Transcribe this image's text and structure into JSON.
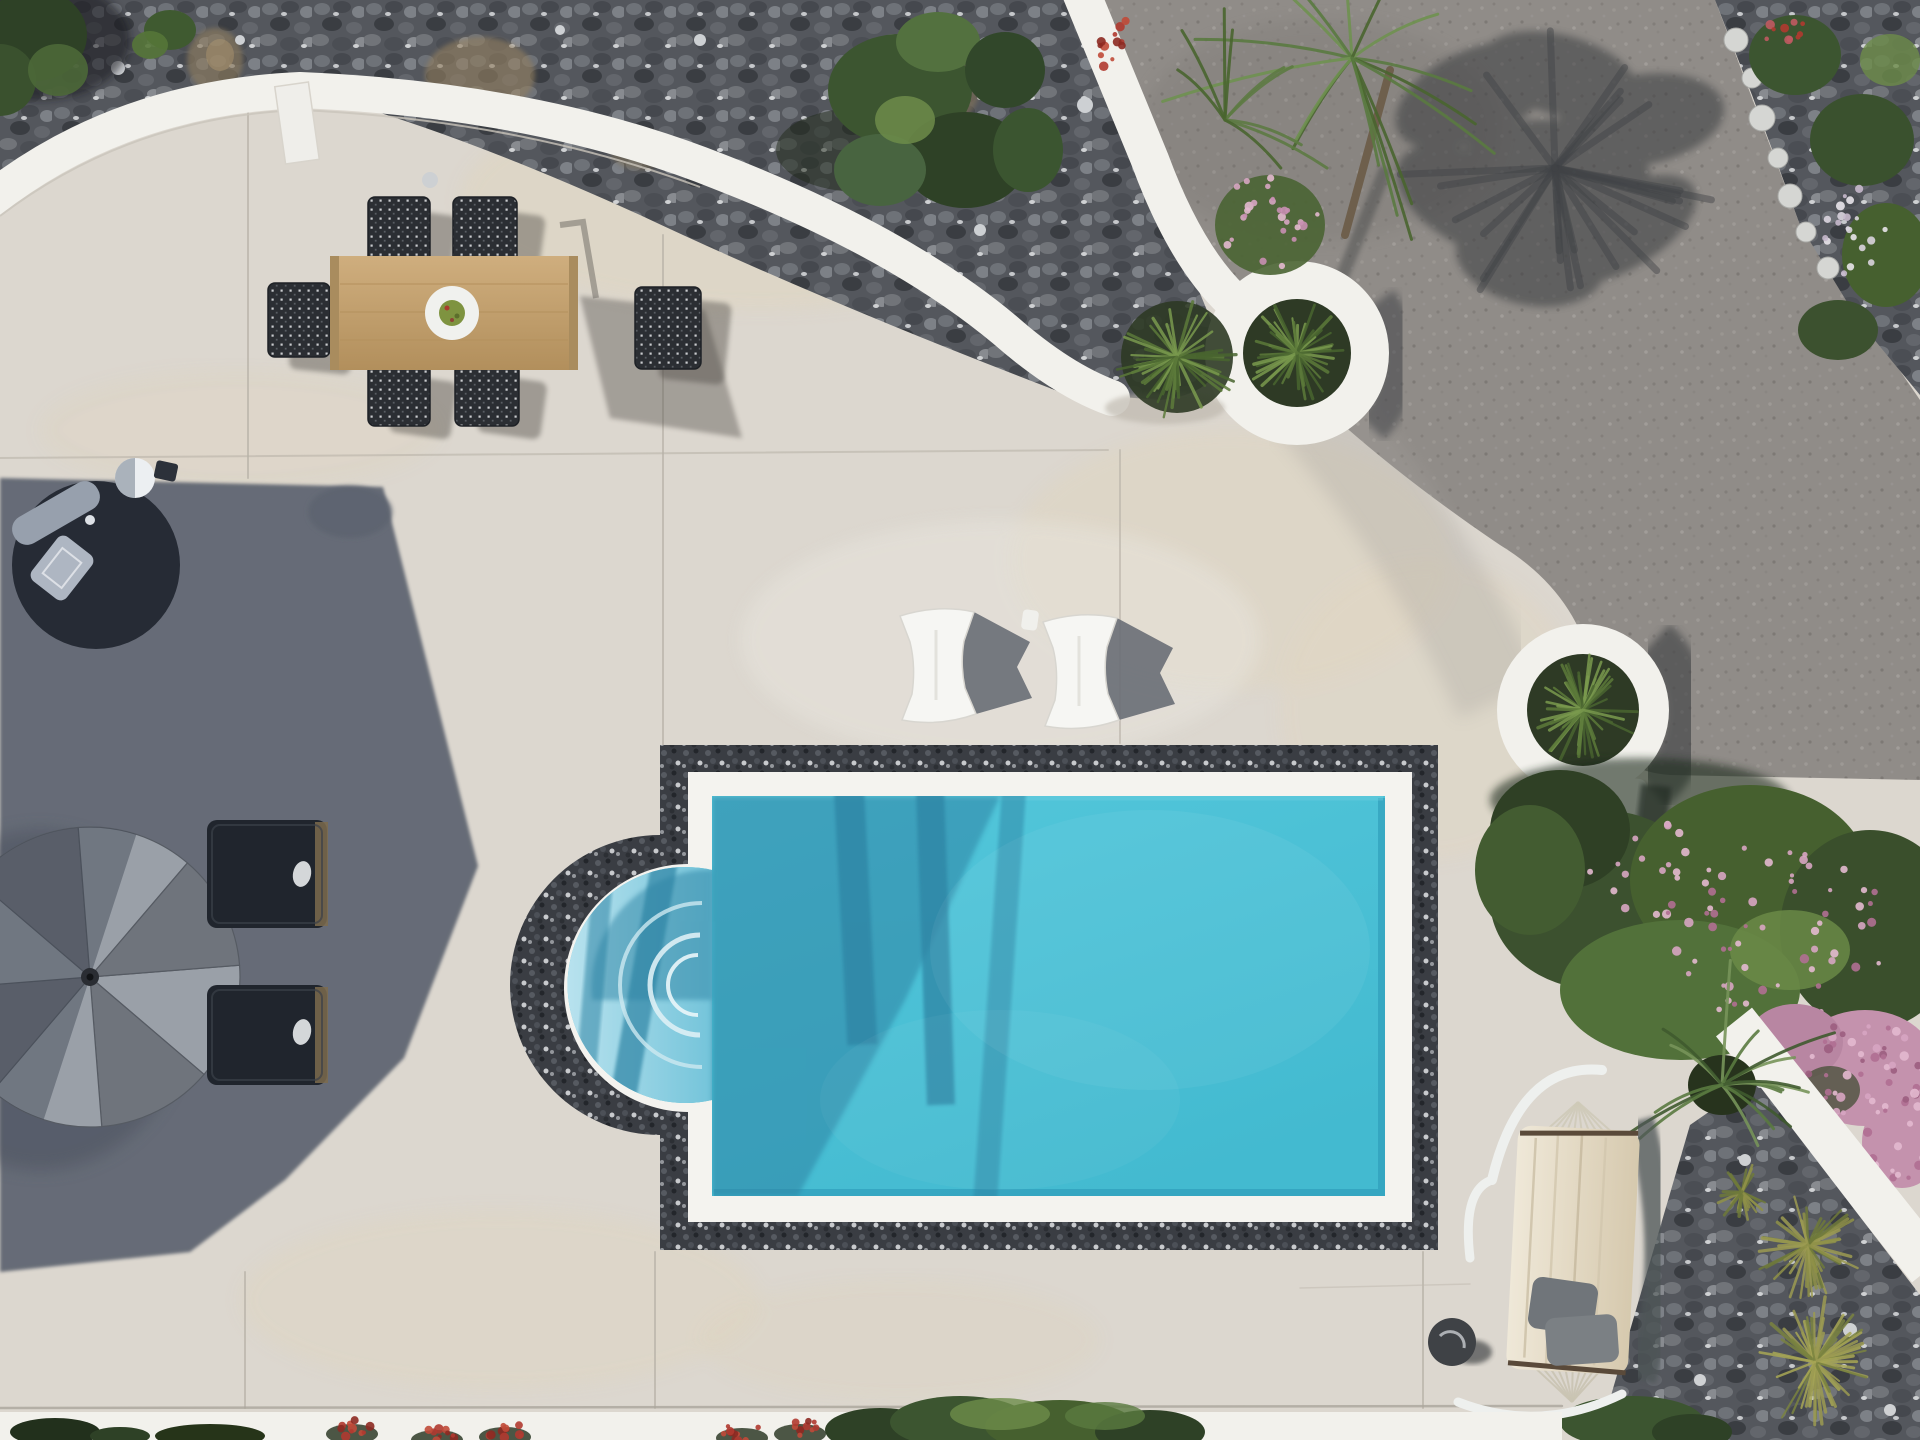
{
  "image": {
    "type": "aerial-drone-photograph",
    "subject": "Whitewashed villa pool terrace seen from directly above, midday hard light",
    "notable_content": "Turquoise rectangular swimming pool with Roman-arch step entry and black pebble surround, teak dining set, grey patio umbrella with two dark sun loungers, round black daybed, two white bean-bag loungers, two white circular grass planters, curved white garden walls, black pebble rock garden, asphalt driveway with palm-tree shadow, oleander and bougainvillea bushes, hammock on stand, pebble bed with grass tufts"
  },
  "colors": {
    "concrete": "#dcd7cf",
    "concrete_warm": "#e0d5bd",
    "concrete_bright": "#e9e6df",
    "white_wall": "#f2f1ec",
    "coping_white": "#f4f3ef",
    "pebble_base": "#3a3d43",
    "stone_base": "#54575d",
    "asphalt": "#908c88",
    "pool_water": "#4ac0d6",
    "pool_water_deep": "#45bcd2",
    "pool_shadow_teal": "#2d84a4",
    "pool_bevel": "#2a96b4",
    "arch_shallow_light": "#b8e2ee",
    "arch_shallow_mid": "#74c4da",
    "step_line": "#ddf0f5",
    "building_shadow": "#5d6370",
    "umbrella_light": "#9aa0a8",
    "umbrella_dark": "#6f747c",
    "daybed_dark": "#262b35",
    "cushion_gray": "#97a0ad",
    "lounger_pad": "#20252d",
    "beanbag_white": "#f6f6f3",
    "beanbag_shadow": "#696e76",
    "wood_light": "#cfae7e",
    "wood_dark": "#b28f5c",
    "chair_weave": "#2b2e33",
    "table_shadow": "#504c46",
    "foliage_dark": "#2e4126",
    "foliage_mid": "#3c5530",
    "foliage_light": "#6d8c4a",
    "grass_green": "#5c7a3a",
    "grass_light": "#7a9a4e",
    "grass_olive": "#9c9b52",
    "flower_pink": "#d7a5c2",
    "flower_pink_deep": "#b06f92",
    "flower_red": "#b03a30",
    "palm_green": "#5a7a40",
    "palm_shadow": "#3a3d41",
    "hammock_fabric": "#e8e0cf",
    "hammock_pillow": "#70757a",
    "joint_line": "#b7b1a7",
    "rock_white": "#d5d6d3"
  },
  "objects": {
    "pool": "rectangular pool, black pebble border, white coping, arched step entry on left",
    "dining_set": "teak table with centerpiece plate and six dark woven chairs",
    "umbrella": "grey octagonal patio umbrella seen from above",
    "daybed": "round dark daybed with grey cushions and small white side table",
    "sun_loungers": "two dark cushioned loungers in building shadow",
    "beanbag_loungers": "two white bean-bag loungers beside the pool",
    "planters": "two round white ring planters with spiky grasses",
    "hammock": "cream hammock on white stand with two grey pillows",
    "driveway": "grey asphalt drive with large palm-frond shadow",
    "gardens": "black pebble rock garden, oleander, bougainvillea, grass tufts"
  }
}
